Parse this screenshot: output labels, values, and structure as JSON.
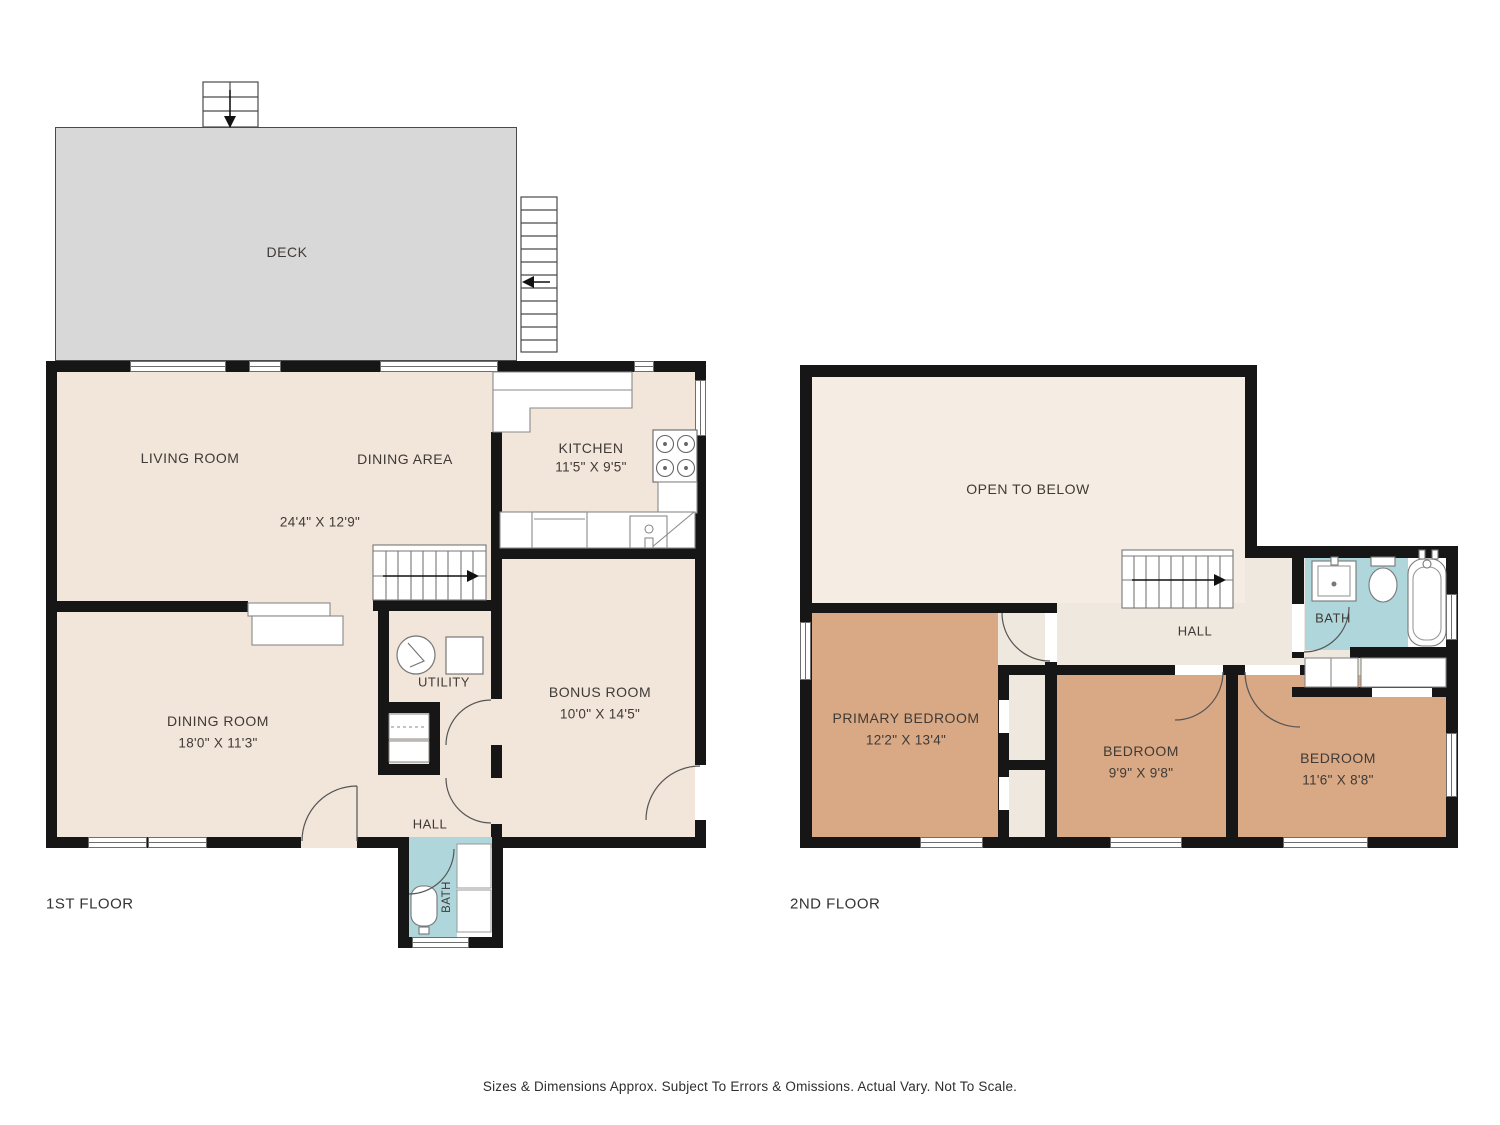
{
  "floor1": {
    "label": "1ST FLOOR",
    "deck": "DECK",
    "living_room": "LIVING ROOM",
    "dining_area": "DINING AREA",
    "living_dining_dims": "24'4\" X 12'9\"",
    "kitchen": "KITCHEN",
    "kitchen_dims": "11'5\" X 9'5\"",
    "dining_room": "DINING ROOM",
    "dining_room_dims": "18'0\" X 11'3\"",
    "utility": "UTILITY",
    "bonus_room": "BONUS ROOM",
    "bonus_room_dims": "10'0\" X 14'5\"",
    "hall": "HALL",
    "bath": "BATH"
  },
  "floor2": {
    "label": "2ND FLOOR",
    "open_to_below": "OPEN TO BELOW",
    "hall": "HALL",
    "bath": "BATH",
    "primary_bedroom": "PRIMARY BEDROOM",
    "primary_bedroom_dims": "12'2\" X 13'4\"",
    "bedroom_mid": "BEDROOM",
    "bedroom_mid_dims": "9'9\" X 9'8\"",
    "bedroom_right": "BEDROOM",
    "bedroom_right_dims": "11'6\" X 8'8\""
  },
  "footer": "Sizes & Dimensions Approx. Subject To Errors & Omissions. Actual Vary. Not To Scale.",
  "colors": {
    "wall": "#161616",
    "floor_cream": "#f2e5da",
    "upper_cream": "#efe8df",
    "open_below_cream": "#f5ece3",
    "bedroom_tan": "#d9a884",
    "bath_teal": "#aed6db",
    "deck_gray": "#d8d8d8"
  }
}
